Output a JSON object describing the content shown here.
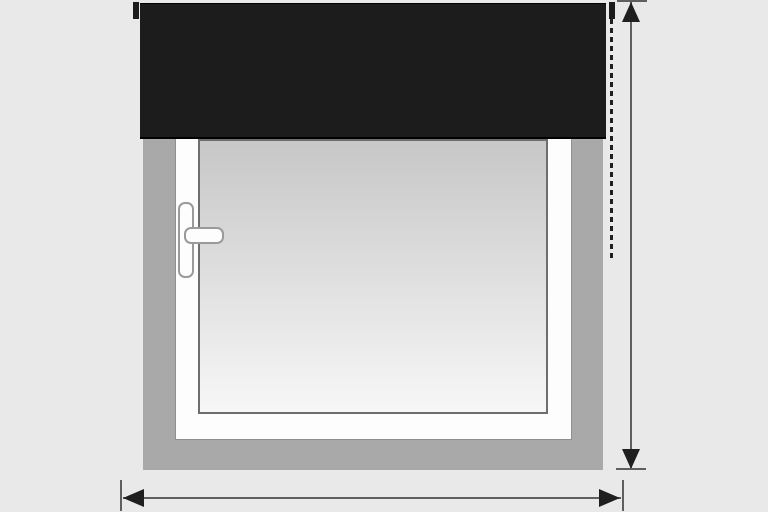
{
  "diagram": {
    "type": "illustration",
    "subject": "roller-blind-outside-mount-measurement",
    "colors": {
      "background": "#e9e9e9",
      "wall": "#a9a9a9",
      "frame": "#fdfdfd",
      "frame_border": "#8f8f8f",
      "glass_top": "#c7c7c7",
      "glass_bottom": "#f7f7f7",
      "glass_border": "#6e6e6e",
      "handle_fill": "#fdfdfd",
      "handle_border": "#9a9a9a",
      "blind": "#1c1c1c",
      "blind_edge": "#000000",
      "dimension_line": "#5f5f5f",
      "dimension_dark": "#1f1f1f"
    },
    "parts": [
      {
        "name": "wall",
        "kind": "surface"
      },
      {
        "name": "window-frame",
        "kind": "frame"
      },
      {
        "name": "window-glass",
        "kind": "glass"
      },
      {
        "name": "window-handle",
        "kind": "hardware"
      },
      {
        "name": "roller-blind",
        "kind": "blind-fabric-and-cassette"
      },
      {
        "name": "blind-bracket-left",
        "kind": "mounting-bracket"
      },
      {
        "name": "blind-bracket-right",
        "kind": "mounting-bracket"
      },
      {
        "name": "blind-chain-dashed-line",
        "kind": "dashed-guide-line"
      },
      {
        "name": "height-dimension",
        "kind": "double-headed-vertical-arrow"
      },
      {
        "name": "width-dimension",
        "kind": "double-headed-horizontal-arrow"
      }
    ]
  }
}
